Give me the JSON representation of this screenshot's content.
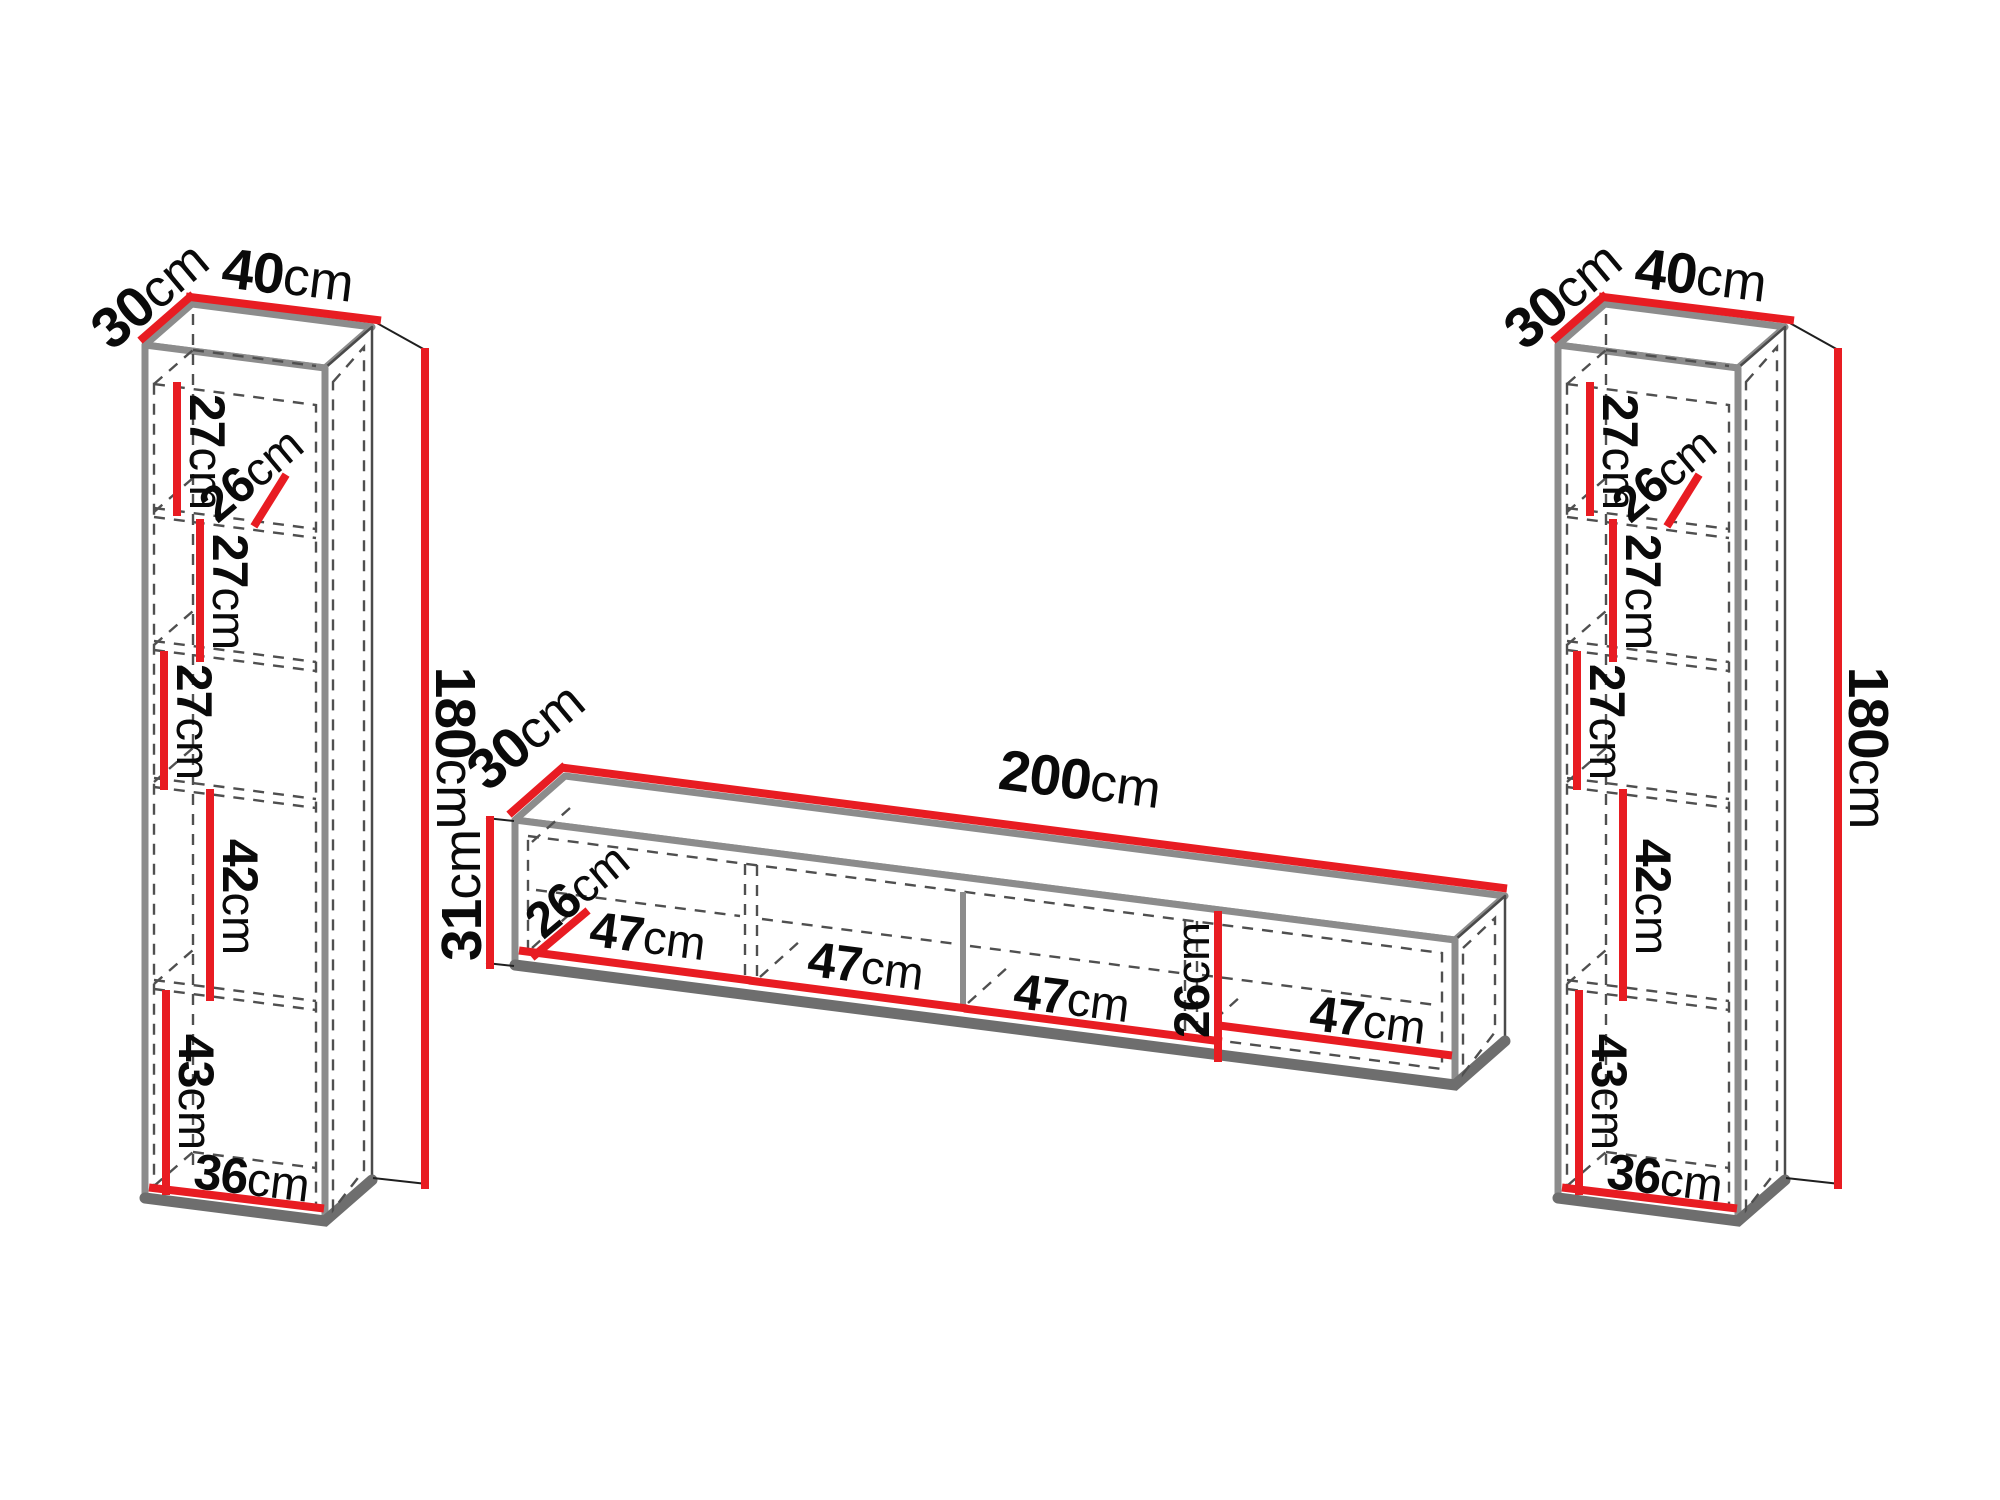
{
  "diagram_title": "Wall unit furniture dimension diagram",
  "colors": {
    "dimension_red": "#e81c22",
    "edge_gray": "#8c8c8c",
    "hidden_dash": "#4f4f4f",
    "label_black": "#0a0a0a"
  },
  "left_cabinet": {
    "label": "tall wall cabinet",
    "width": {
      "v": "40",
      "u": "cm"
    },
    "depth": {
      "v": "30",
      "u": "cm"
    },
    "height": {
      "v": "180",
      "u": "cm"
    },
    "inner": [
      {
        "name": "top-section-height",
        "v": "27",
        "u": "cm"
      },
      {
        "name": "shelf-depth",
        "v": "26",
        "u": "cm"
      },
      {
        "name": "second-section-height",
        "v": "27",
        "u": "cm"
      },
      {
        "name": "third-section-height",
        "v": "27",
        "u": "cm"
      },
      {
        "name": "fourth-section-height",
        "v": "42",
        "u": "cm"
      },
      {
        "name": "fifth-section-height",
        "v": "43",
        "u": "cm"
      },
      {
        "name": "interior-width",
        "v": "36",
        "u": "cm"
      }
    ]
  },
  "tv_stand": {
    "label": "TV stand",
    "width": {
      "v": "200",
      "u": "cm"
    },
    "depth": {
      "v": "30",
      "u": "cm"
    },
    "height": {
      "v": "31",
      "u": "cm"
    },
    "inner": [
      {
        "name": "interior-depth",
        "v": "26",
        "u": "cm"
      },
      {
        "name": "compartment-1-width",
        "v": "47",
        "u": "cm"
      },
      {
        "name": "compartment-2-width",
        "v": "47",
        "u": "cm"
      },
      {
        "name": "compartment-3-width",
        "v": "47",
        "u": "cm"
      },
      {
        "name": "interior-height",
        "v": "26",
        "u": "cm"
      },
      {
        "name": "compartment-4-width",
        "v": "47",
        "u": "cm"
      }
    ]
  },
  "right_cabinet": {
    "label": "tall wall cabinet",
    "width": {
      "v": "40",
      "u": "cm"
    },
    "depth": {
      "v": "30",
      "u": "cm"
    },
    "height": {
      "v": "180",
      "u": "cm"
    },
    "inner": [
      {
        "name": "top-section-height",
        "v": "27",
        "u": "cm"
      },
      {
        "name": "shelf-depth",
        "v": "26",
        "u": "cm"
      },
      {
        "name": "second-section-height",
        "v": "27",
        "u": "cm"
      },
      {
        "name": "third-section-height",
        "v": "27",
        "u": "cm"
      },
      {
        "name": "fourth-section-height",
        "v": "42",
        "u": "cm"
      },
      {
        "name": "fifth-section-height",
        "v": "43",
        "u": "cm"
      },
      {
        "name": "interior-width",
        "v": "36",
        "u": "cm"
      }
    ]
  }
}
